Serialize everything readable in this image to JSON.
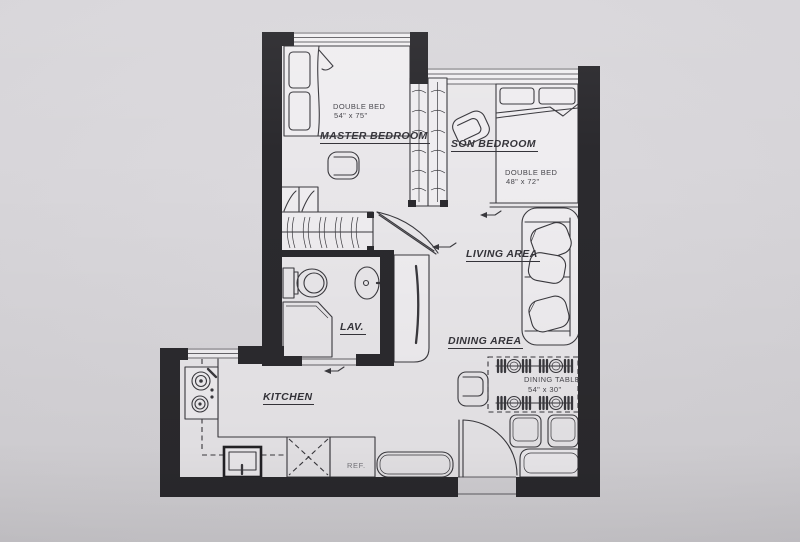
{
  "rooms": {
    "master_bedroom": {
      "label": "MASTER BEDROOM",
      "bed_line1": "DOUBLE BED",
      "bed_line2": "54\" x 75\""
    },
    "son_bedroom": {
      "label": "SON BEDROOM",
      "bed_line1": "DOUBLE BED",
      "bed_line2": "48\" x 72\""
    },
    "living_area": {
      "label": "LIVING AREA"
    },
    "dining_area": {
      "label": "DINING AREA",
      "table_line1": "DINING TABLE",
      "table_line2": "54\" x 30\""
    },
    "kitchen": {
      "label": "KITCHEN",
      "fridge_label": "REF."
    },
    "lavatory": {
      "label": "LAV."
    }
  },
  "colors": {
    "wall": "#2b2a2e",
    "paper": "#d5d3d7",
    "floor": "#e9e7ea",
    "line": "#3a393e",
    "text": "#35343a"
  }
}
